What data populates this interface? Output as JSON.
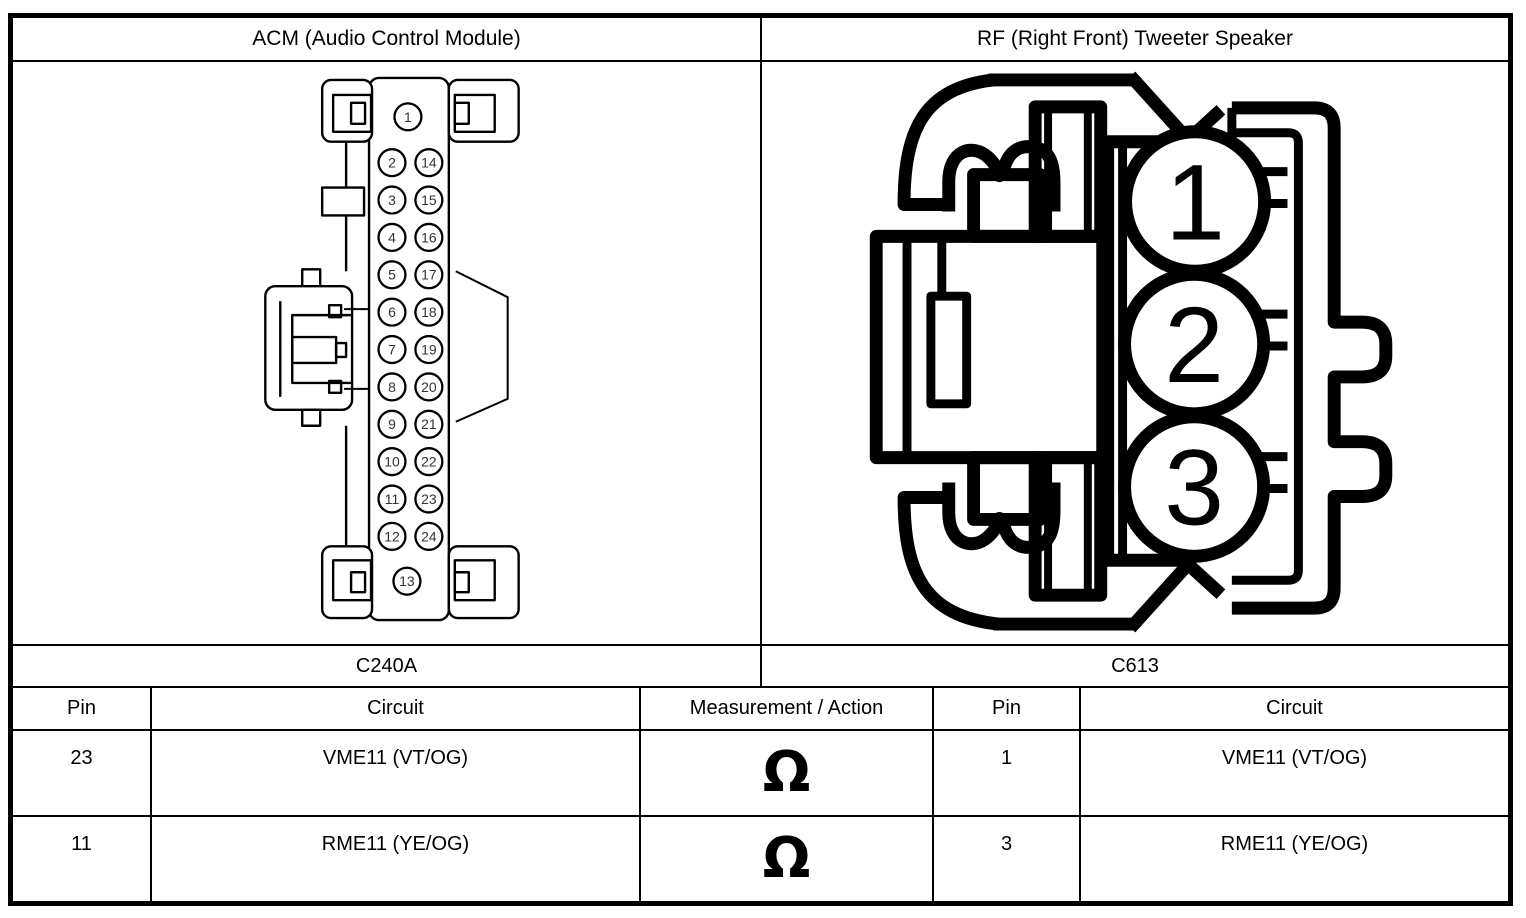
{
  "panels": {
    "acm": {
      "title": "ACM (Audio Control Module)",
      "connector_label": "C240A",
      "pin_top": "1",
      "pin_bottom": "13",
      "pin_rows": [
        [
          "2",
          "14"
        ],
        [
          "3",
          "15"
        ],
        [
          "4",
          "16"
        ],
        [
          "5",
          "17"
        ],
        [
          "6",
          "18"
        ],
        [
          "7",
          "19"
        ],
        [
          "8",
          "20"
        ],
        [
          "9",
          "21"
        ],
        [
          "10",
          "22"
        ],
        [
          "11",
          "23"
        ],
        [
          "12",
          "24"
        ]
      ]
    },
    "tweeter": {
      "title": "RF (Right Front) Tweeter Speaker",
      "connector_label": "C613",
      "pins": [
        "1",
        "2",
        "3"
      ]
    }
  },
  "table": {
    "headers": [
      "Pin",
      "Circuit",
      "Measurement / Action",
      "Pin",
      "Circuit"
    ],
    "rows": [
      {
        "left_pin": "23",
        "left_circuit": "VME11 (VT/OG)",
        "measurement": "Ω",
        "right_pin": "1",
        "right_circuit": "VME11 (VT/OG)"
      },
      {
        "left_pin": "11",
        "left_circuit": "RME11 (YE/OG)",
        "measurement": "Ω",
        "right_pin": "3",
        "right_circuit": "RME11 (YE/OG)"
      }
    ]
  },
  "colors": {
    "line": "#000000",
    "background": "#ffffff"
  }
}
